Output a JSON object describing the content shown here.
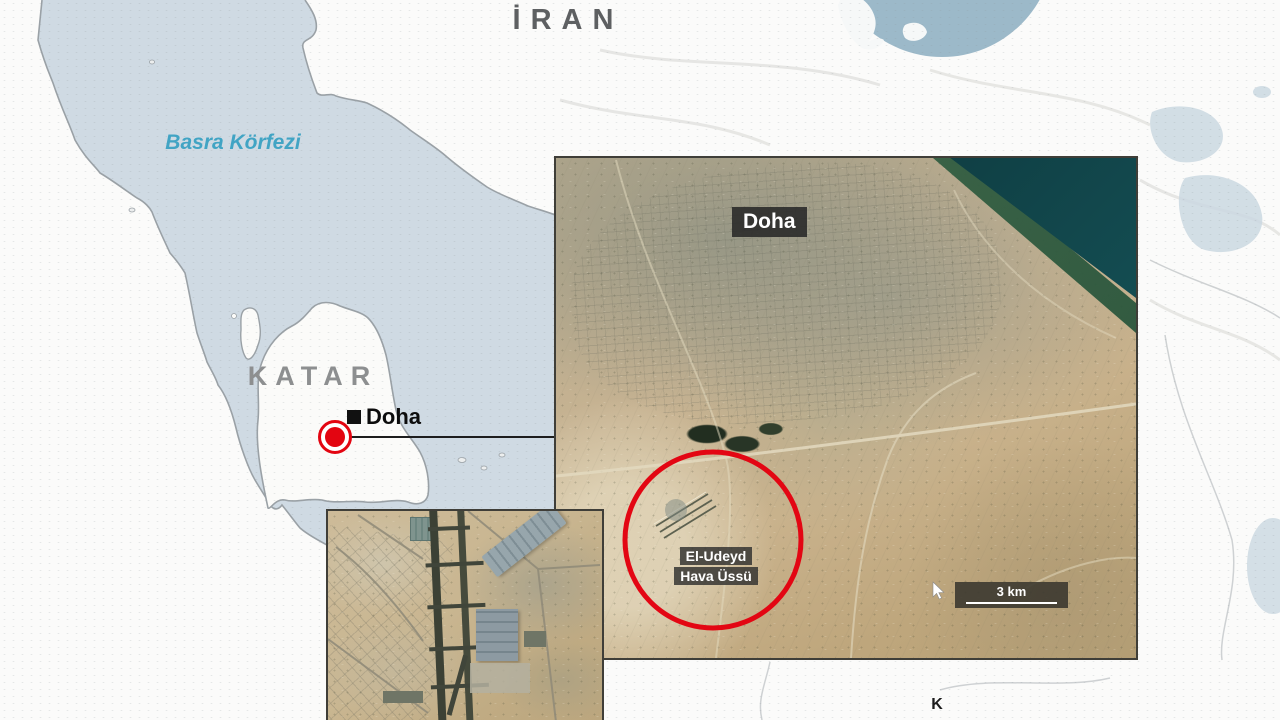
{
  "base_map": {
    "country_label_top": "İRAN",
    "sea_label": "Basra Körfezi",
    "country_label_qatar": "KATAR",
    "capital_label": "Doha",
    "colors": {
      "water": "#cfdae3",
      "land": "#fbfbfa",
      "sea_label_color": "#41a4c4",
      "country_label_color": "#8d8f90",
      "marker_red": "#e30511",
      "globe_ocean": "#9cb9c9"
    }
  },
  "satellite_inset": {
    "city_label": "Doha",
    "site_label_line1": "El-Udeyd",
    "site_label_line2": "Hava Üssü",
    "scale_bar_label": "3 km",
    "highlight_circle_color": "#e30613"
  },
  "north_indicator": {
    "label": "K"
  }
}
